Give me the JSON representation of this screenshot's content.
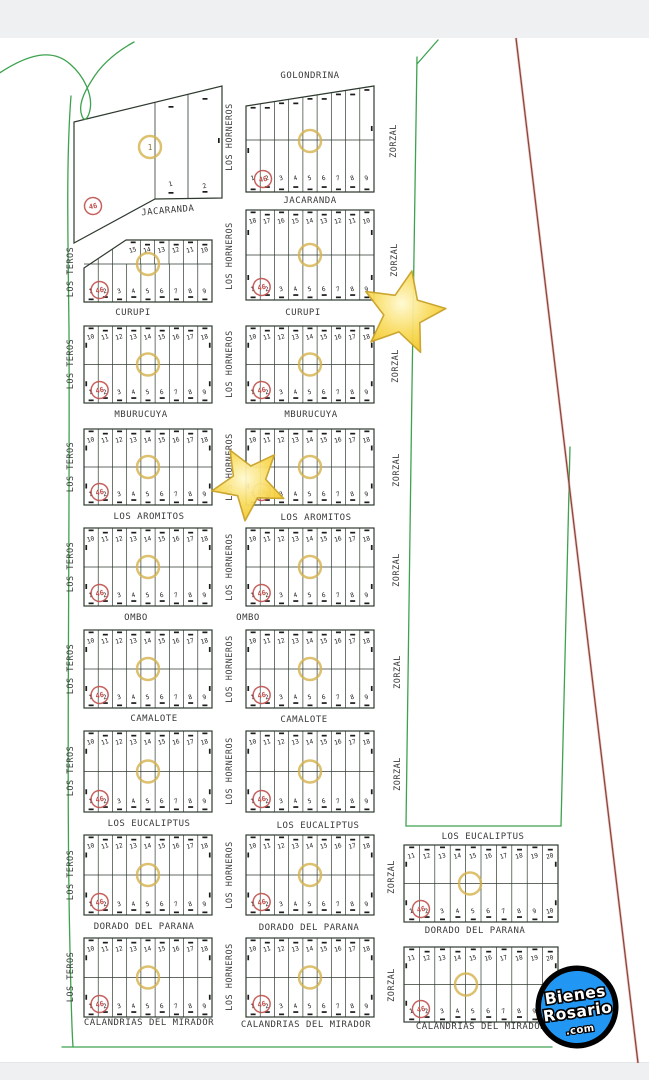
{
  "window": {
    "width": 649,
    "height": 1080
  },
  "colors": {
    "letterbox": "#eef0f2",
    "paper": "#ffffff",
    "boundary_green": "#3da24f",
    "parcel_line": "#2f3a2f",
    "tick": "#1c1c1c",
    "label_text": "#3a3a3a",
    "lot_number": "#222222",
    "survey_red_line": "#8f453e",
    "survey_red_halo": "#dca49b",
    "stamp_red": "#c0504d",
    "block_circle_yellow": "#d4b24a",
    "star_fill_light": "#fffad2",
    "star_fill_mid": "#f9dc60",
    "star_fill_dark": "#f2c51f",
    "star_stroke": "#c9a227",
    "logo_blue": "#2197f3",
    "logo_ring": "#000000",
    "logo_text_color": "#ffffff"
  },
  "stamps": {
    "red_text": "46"
  },
  "streets": {
    "horizontal": [
      {
        "t": "GOLONDRINA",
        "x": 310,
        "y": 78
      },
      {
        "t": "JACARANDA",
        "x": 168,
        "y": 213,
        "r": -5
      },
      {
        "t": "JACARANDA",
        "x": 310,
        "y": 203
      },
      {
        "t": "CURUPI",
        "x": 133,
        "y": 315
      },
      {
        "t": "CURUPI",
        "x": 303,
        "y": 315
      },
      {
        "t": "MBURUCUYA",
        "x": 141,
        "y": 417
      },
      {
        "t": "MBURUCUYA",
        "x": 311,
        "y": 417
      },
      {
        "t": "LOS AROMITOS",
        "x": 149,
        "y": 519
      },
      {
        "t": "LOS AROMITOS",
        "x": 316,
        "y": 520
      },
      {
        "t": "OMBO",
        "x": 136,
        "y": 620
      },
      {
        "t": "OMBO",
        "x": 248,
        "y": 620
      },
      {
        "t": "CAMALOTE",
        "x": 154,
        "y": 721
      },
      {
        "t": "CAMALOTE",
        "x": 304,
        "y": 722
      },
      {
        "t": "LOS EUCALIPTUS",
        "x": 149,
        "y": 826
      },
      {
        "t": "LOS EUCALIPTUS",
        "x": 318,
        "y": 828
      },
      {
        "t": "LOS EUCALIPTUS",
        "x": 483,
        "y": 839
      },
      {
        "t": "DORADO DEL PARANA",
        "x": 144,
        "y": 929
      },
      {
        "t": "DORADO DEL PARANA",
        "x": 309,
        "y": 930
      },
      {
        "t": "DORADO DEL PARANA",
        "x": 475,
        "y": 933
      },
      {
        "t": "CALANDRIAS DEL MIRADOR",
        "x": 149,
        "y": 1025
      },
      {
        "t": "CALANDRIAS DEL MIRADOR",
        "x": 306,
        "y": 1027
      },
      {
        "t": "CALANDRIAS DEL MIRADOR",
        "x": 481,
        "y": 1029
      }
    ],
    "vertical": [
      {
        "t": "LOS TEROS",
        "x": 73,
        "y": 272
      },
      {
        "t": "LOS TEROS",
        "x": 73,
        "y": 364
      },
      {
        "t": "LOS TEROS",
        "x": 73,
        "y": 467
      },
      {
        "t": "LOS TEROS",
        "x": 73,
        "y": 567
      },
      {
        "t": "LOS TEROS",
        "x": 73,
        "y": 669
      },
      {
        "t": "LOS TEROS",
        "x": 73,
        "y": 771
      },
      {
        "t": "LOS TEROS",
        "x": 73,
        "y": 875
      },
      {
        "t": "LOS TEROS",
        "x": 73,
        "y": 977
      },
      {
        "t": "LOS HORNEROS",
        "x": 232,
        "y": 137
      },
      {
        "t": "LOS HORNEROS",
        "x": 232,
        "y": 256
      },
      {
        "t": "LOS HORNEROS",
        "x": 232,
        "y": 364
      },
      {
        "t": "LOS HORNEROS",
        "x": 232,
        "y": 467
      },
      {
        "t": "LOS HORNEROS",
        "x": 232,
        "y": 567
      },
      {
        "t": "LOS HORNEROS",
        "x": 232,
        "y": 669
      },
      {
        "t": "LOS HORNEROS",
        "x": 232,
        "y": 771
      },
      {
        "t": "LOS HORNEROS",
        "x": 232,
        "y": 875
      },
      {
        "t": "LOS HORNEROS",
        "x": 232,
        "y": 977
      },
      {
        "t": "ZORZAL",
        "x": 396,
        "y": 141
      },
      {
        "t": "ZORZAL",
        "x": 397,
        "y": 260
      },
      {
        "t": "ZORZAL",
        "x": 398,
        "y": 366
      },
      {
        "t": "ZORZAL",
        "x": 399,
        "y": 470
      },
      {
        "t": "ZORZAL",
        "x": 399,
        "y": 570
      },
      {
        "t": "ZORZAL",
        "x": 400,
        "y": 672
      },
      {
        "t": "ZORZAL",
        "x": 400,
        "y": 774
      },
      {
        "t": "ZORZAL",
        "x": 394,
        "y": 877
      },
      {
        "t": "ZORZAL",
        "x": 394,
        "y": 985
      }
    ]
  },
  "blocks": [
    {
      "id": "1-left",
      "type": "custom",
      "outline": "74,122 222,86 222,198 155,199 74,243",
      "lines": [
        [
          155,
          102,
          155,
          199
        ],
        [
          188,
          94,
          188,
          198
        ]
      ],
      "lots": [
        {
          "t": "1",
          "x": 171,
          "y": 186
        },
        {
          "t": "2",
          "x": 205,
          "y": 188
        }
      ],
      "ticks": [
        [
          171,
          106
        ],
        [
          205,
          98
        ],
        [
          171,
          192
        ],
        [
          205,
          191
        ]
      ],
      "circle": {
        "x": 150,
        "y": 147,
        "t": "1"
      },
      "stamp": {
        "x": 93,
        "y": 206
      }
    },
    {
      "id": "1-right",
      "type": "slant",
      "x": 246,
      "w": 128,
      "topL": 106,
      "topR": 86,
      "bottom": 192,
      "mid": 140,
      "top": [],
      "bot": [
        "1",
        "2",
        "3",
        "4",
        "5",
        "6",
        "7",
        "8",
        "9"
      ],
      "circle": {},
      "stamp": {
        "x": 263,
        "y": 179
      }
    },
    {
      "id": "2-left",
      "type": "cut",
      "x": 84,
      "w": 128,
      "y": 268,
      "yTop": 240,
      "x1": 126,
      "bottom": 302,
      "mid": 264,
      "top": [
        "15",
        "14",
        "13",
        "12",
        "11",
        "10"
      ],
      "bot": [
        "1",
        "2",
        "3",
        "4",
        "5",
        "6",
        "7",
        "8",
        "9"
      ],
      "circle": {},
      "stamp": {}
    },
    {
      "id": "2-right",
      "type": "std",
      "x": 246,
      "y": 210,
      "w": 128,
      "h": 90,
      "mid": 255,
      "top": [
        "18",
        "17",
        "16",
        "15",
        "14",
        "13",
        "12",
        "11",
        "10"
      ],
      "bot": [
        "1",
        "2",
        "3",
        "4",
        "5",
        "6",
        "7",
        "8",
        "9"
      ],
      "circle": {},
      "stamp": {}
    },
    {
      "id": "3-left",
      "type": "std",
      "x": 84,
      "y": 326,
      "w": 128,
      "h": 77,
      "top": [
        "10",
        "11",
        "12",
        "13",
        "14",
        "15",
        "16",
        "17",
        "18"
      ],
      "bot": [
        "1",
        "2",
        "3",
        "4",
        "5",
        "6",
        "7",
        "8",
        "9"
      ],
      "circle": {},
      "stamp": {}
    },
    {
      "id": "3-right",
      "type": "std",
      "x": 246,
      "y": 326,
      "w": 128,
      "h": 77,
      "top": [
        "10",
        "11",
        "12",
        "13",
        "14",
        "15",
        "16",
        "17",
        "18"
      ],
      "bot": [
        "1",
        "2",
        "3",
        "4",
        "5",
        "6",
        "7",
        "8",
        "9"
      ],
      "circle": {},
      "stamp": {}
    },
    {
      "id": "4-left",
      "type": "std",
      "x": 84,
      "y": 429,
      "w": 128,
      "h": 76,
      "top": [
        "10",
        "11",
        "12",
        "13",
        "14",
        "15",
        "16",
        "17",
        "18"
      ],
      "bot": [
        "1",
        "2",
        "3",
        "4",
        "5",
        "6",
        "7",
        "8",
        "9"
      ],
      "circle": {},
      "stamp": {}
    },
    {
      "id": "4-right",
      "type": "std",
      "x": 246,
      "y": 429,
      "w": 128,
      "h": 76,
      "top": [
        "10",
        "11",
        "12",
        "13",
        "14",
        "15",
        "16",
        "17",
        "18"
      ],
      "bot": [
        "1",
        "2",
        "3",
        "4",
        "5",
        "6",
        "7",
        "8",
        "9"
      ],
      "circle": {},
      "stamp": {}
    },
    {
      "id": "5-left",
      "type": "std",
      "x": 84,
      "y": 528,
      "w": 128,
      "h": 78,
      "top": [
        "10",
        "11",
        "12",
        "13",
        "14",
        "15",
        "16",
        "17",
        "18"
      ],
      "bot": [
        "1",
        "2",
        "3",
        "4",
        "5",
        "6",
        "7",
        "8",
        "9"
      ],
      "circle": {},
      "stamp": {}
    },
    {
      "id": "5-right",
      "type": "std",
      "x": 246,
      "y": 528,
      "w": 128,
      "h": 78,
      "top": [
        "10",
        "11",
        "12",
        "13",
        "14",
        "15",
        "16",
        "17",
        "18"
      ],
      "bot": [
        "1",
        "2",
        "3",
        "4",
        "5",
        "6",
        "7",
        "8",
        "9"
      ],
      "circle": {},
      "stamp": {}
    },
    {
      "id": "6-left",
      "type": "std",
      "x": 84,
      "y": 630,
      "w": 128,
      "h": 78,
      "top": [
        "10",
        "11",
        "12",
        "13",
        "14",
        "15",
        "16",
        "17",
        "18"
      ],
      "bot": [
        "1",
        "2",
        "3",
        "4",
        "5",
        "6",
        "7",
        "8",
        "9"
      ],
      "circle": {},
      "stamp": {}
    },
    {
      "id": "6-right",
      "type": "std",
      "x": 246,
      "y": 630,
      "w": 128,
      "h": 78,
      "top": [
        "10",
        "11",
        "12",
        "13",
        "14",
        "15",
        "16",
        "17",
        "18"
      ],
      "bot": [
        "1",
        "2",
        "3",
        "4",
        "5",
        "6",
        "7",
        "8",
        "9"
      ],
      "circle": {},
      "stamp": {}
    },
    {
      "id": "7-left",
      "type": "std",
      "x": 84,
      "y": 731,
      "w": 128,
      "h": 81,
      "top": [
        "10",
        "11",
        "12",
        "13",
        "14",
        "15",
        "16",
        "17",
        "18"
      ],
      "bot": [
        "1",
        "2",
        "3",
        "4",
        "5",
        "6",
        "7",
        "8",
        "9"
      ],
      "circle": {},
      "stamp": {}
    },
    {
      "id": "7-right",
      "type": "std",
      "x": 246,
      "y": 731,
      "w": 128,
      "h": 81,
      "top": [
        "10",
        "11",
        "12",
        "13",
        "14",
        "15",
        "16",
        "17",
        "18"
      ],
      "bot": [
        "1",
        "2",
        "3",
        "4",
        "5",
        "6",
        "7",
        "8",
        "9"
      ],
      "circle": {},
      "stamp": {}
    },
    {
      "id": "8-left",
      "type": "std",
      "x": 84,
      "y": 835,
      "w": 128,
      "h": 80,
      "top": [
        "10",
        "11",
        "12",
        "13",
        "14",
        "15",
        "16",
        "17",
        "18"
      ],
      "bot": [
        "1",
        "2",
        "3",
        "4",
        "5",
        "6",
        "7",
        "8",
        "9"
      ],
      "circle": {},
      "stamp": {}
    },
    {
      "id": "8-right",
      "type": "std",
      "x": 246,
      "y": 835,
      "w": 128,
      "h": 80,
      "top": [
        "10",
        "11",
        "12",
        "13",
        "14",
        "15",
        "16",
        "17",
        "18"
      ],
      "bot": [
        "1",
        "2",
        "3",
        "4",
        "5",
        "6",
        "7",
        "8",
        "9"
      ],
      "circle": {},
      "stamp": {}
    },
    {
      "id": "8-east",
      "type": "std",
      "x": 404,
      "y": 845,
      "w": 154,
      "h": 77,
      "ccx": 470,
      "top": [
        "11",
        "12",
        "13",
        "14",
        "15",
        "16",
        "17",
        "18",
        "19",
        "20"
      ],
      "bot": [
        "1",
        "2",
        "3",
        "4",
        "5",
        "6",
        "7",
        "8",
        "9",
        "10"
      ],
      "circle": {},
      "stamp": {}
    },
    {
      "id": "9-left",
      "type": "std",
      "x": 84,
      "y": 938,
      "w": 128,
      "h": 79,
      "top": [
        "10",
        "11",
        "12",
        "13",
        "14",
        "15",
        "16",
        "17",
        "18"
      ],
      "bot": [
        "1",
        "2",
        "3",
        "4",
        "5",
        "6",
        "7",
        "8",
        "9"
      ],
      "circle": {},
      "stamp": {}
    },
    {
      "id": "9-right",
      "type": "std",
      "x": 246,
      "y": 938,
      "w": 128,
      "h": 79,
      "top": [
        "10",
        "11",
        "12",
        "13",
        "14",
        "15",
        "16",
        "17",
        "18"
      ],
      "bot": [
        "1",
        "2",
        "3",
        "4",
        "5",
        "6",
        "7",
        "8",
        "9"
      ],
      "circle": {},
      "stamp": {}
    },
    {
      "id": "9-east",
      "type": "std",
      "x": 404,
      "y": 947,
      "w": 154,
      "h": 75,
      "ccx": 466,
      "top": [
        "11",
        "12",
        "13",
        "14",
        "15",
        "16",
        "17",
        "18",
        "19",
        "20"
      ],
      "bot": [
        "1",
        "2",
        "3",
        "4",
        "5",
        "6",
        "7",
        "8",
        "9",
        "10"
      ],
      "circle": {},
      "stamp": {}
    }
  ],
  "stars": [
    {
      "cx": 403,
      "cy": 313,
      "r": 43,
      "rot": 12
    },
    {
      "cx": 249,
      "cy": 483,
      "r": 38,
      "rot": -30
    }
  ],
  "logo": {
    "line1": "Bienes",
    "line2": "Rosario",
    "line3": ".com"
  }
}
